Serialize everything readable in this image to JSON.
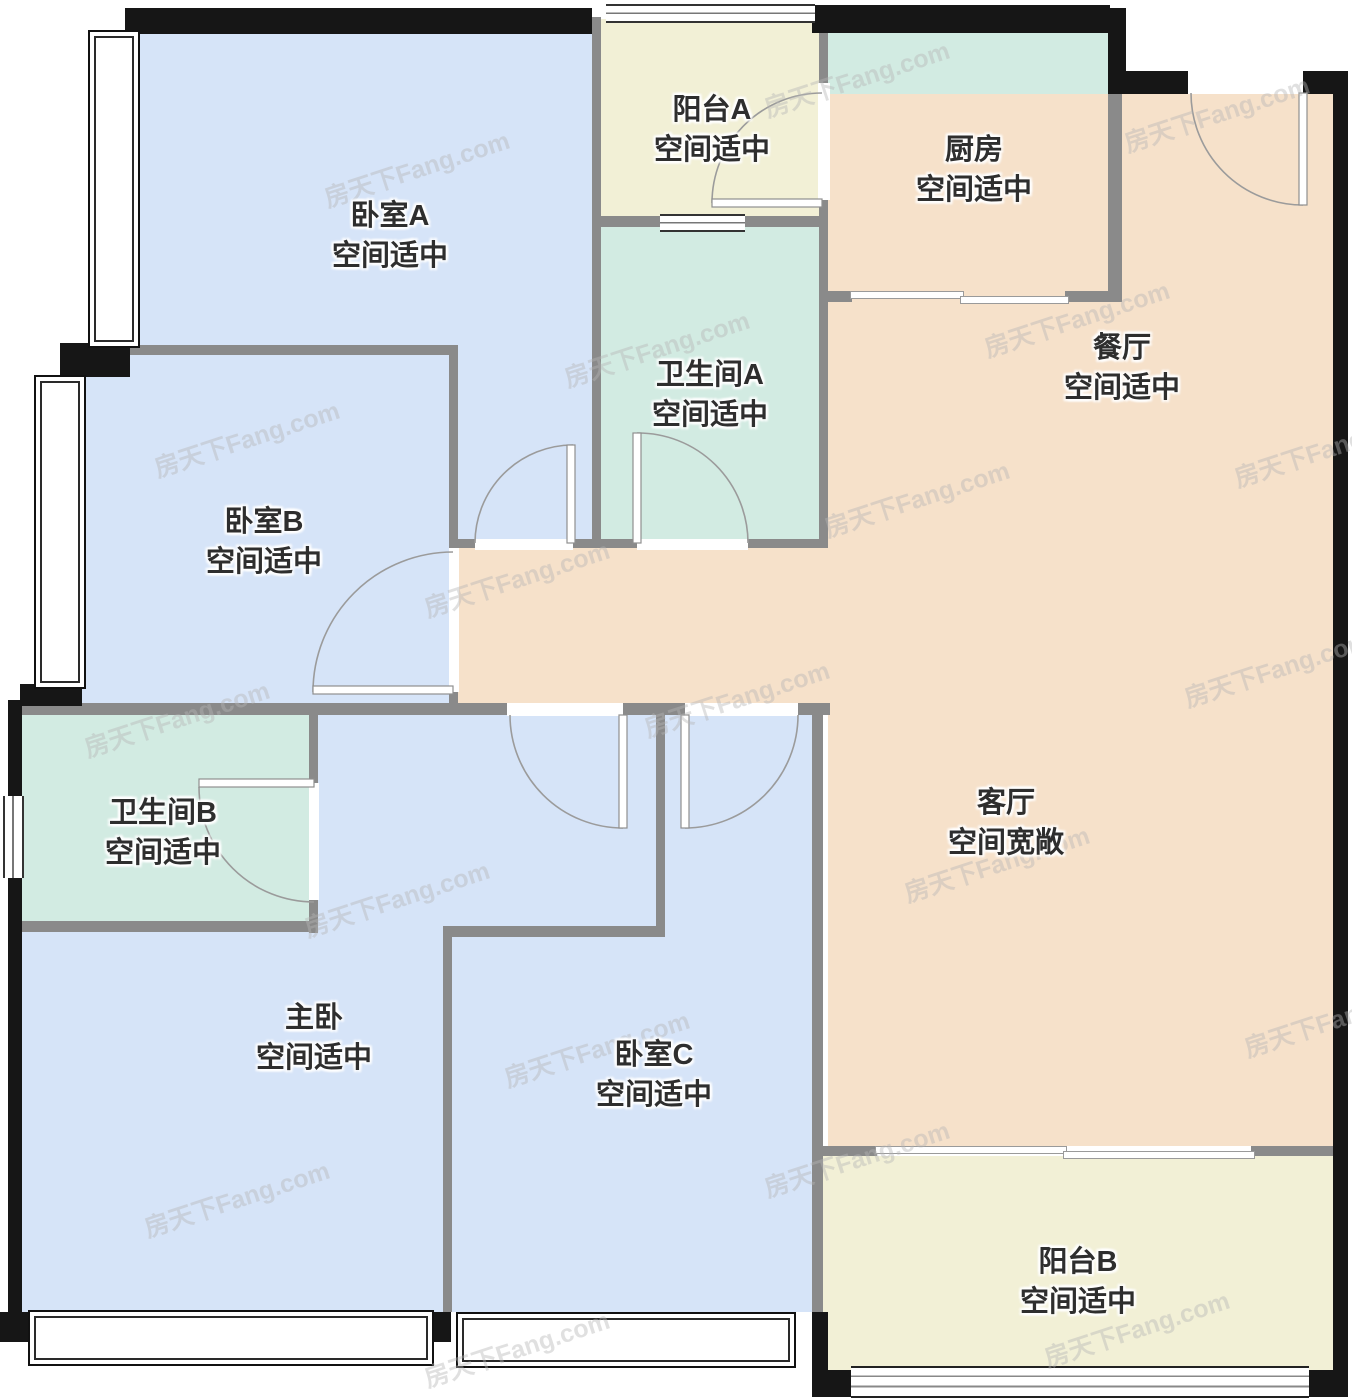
{
  "floorplan": {
    "watermark": "房天下Fang.com",
    "colors": {
      "bedroom_fill": "#d6e4f8",
      "bath_kitchen_fill": "#d2ebe2",
      "balcony_fill": "#f2f0d6",
      "living_fill": "#f6e1ca",
      "wall_gray": "#8a8a8a",
      "wall_black": "#161616",
      "label_text": "#2e2e2e"
    },
    "rooms": [
      {
        "id": "bedroom-a",
        "name": "卧室A",
        "note": "空间适中"
      },
      {
        "id": "balcony-a",
        "name": "阳台A",
        "note": "空间适中"
      },
      {
        "id": "kitchen",
        "name": "厨房",
        "note": "空间适中"
      },
      {
        "id": "dining",
        "name": "餐厅",
        "note": "空间适中"
      },
      {
        "id": "bathroom-a",
        "name": "卫生间A",
        "note": "空间适中"
      },
      {
        "id": "bedroom-b",
        "name": "卧室B",
        "note": "空间适中"
      },
      {
        "id": "bathroom-b",
        "name": "卫生间B",
        "note": "空间适中"
      },
      {
        "id": "living",
        "name": "客厅",
        "note": "空间宽敞"
      },
      {
        "id": "master",
        "name": "主卧",
        "note": "空间适中"
      },
      {
        "id": "bedroom-c",
        "name": "卧室C",
        "note": "空间适中"
      },
      {
        "id": "balcony-b",
        "name": "阳台B",
        "note": "空间适中"
      }
    ]
  }
}
